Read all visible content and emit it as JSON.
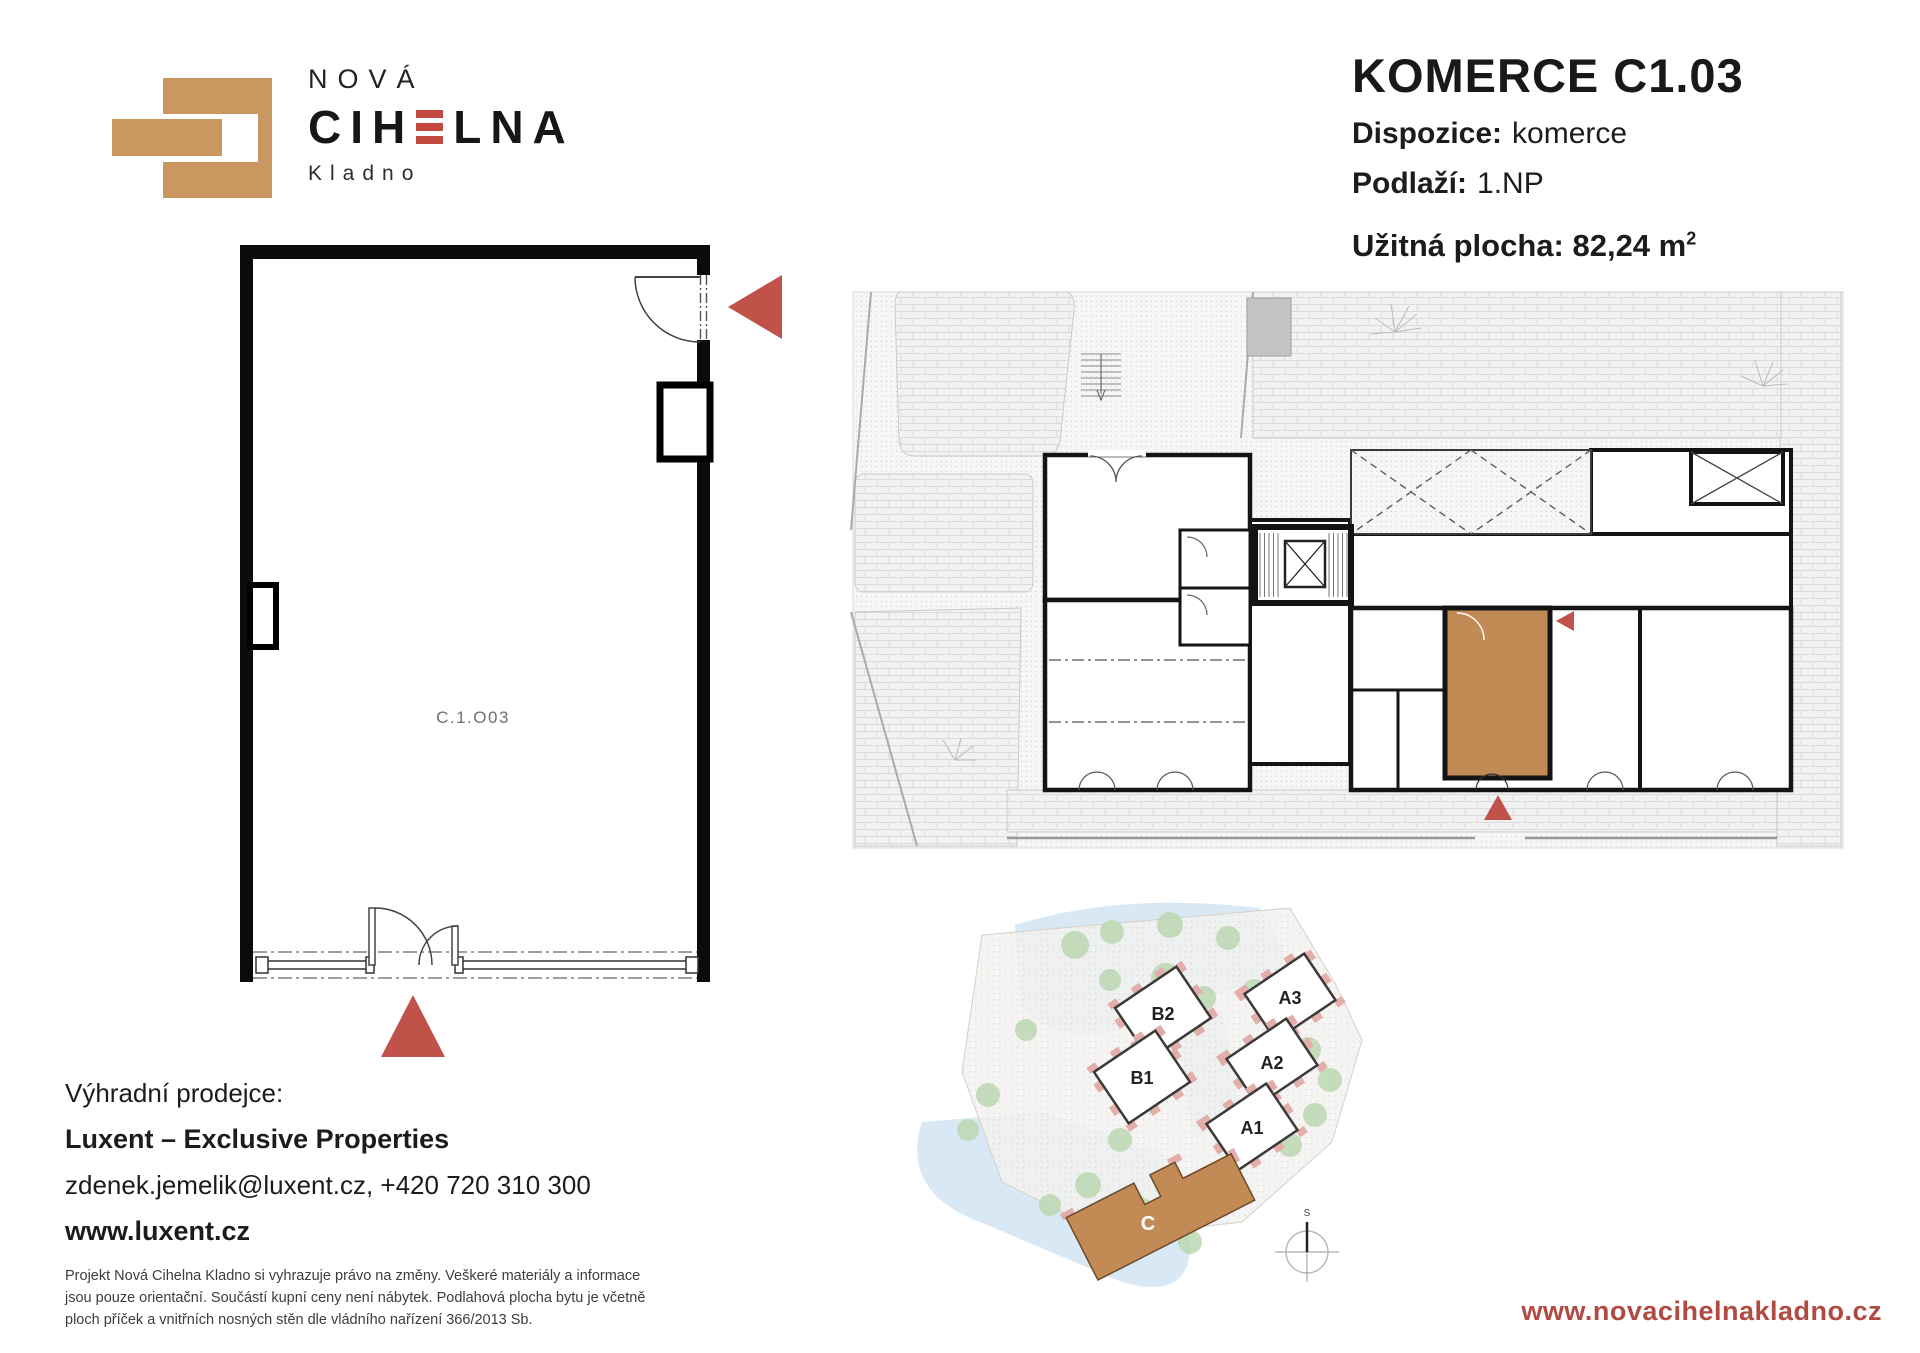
{
  "colors": {
    "brick": "#c9975f",
    "e_bar": "#c2493f",
    "marker_red": "#c0524a",
    "unit_highlight": "#c28b55",
    "url_red": "#b04a42",
    "tree_green": "#b9d6ae",
    "path_blue": "#d9e8f5"
  },
  "logo": {
    "name_top": "NOVÁ",
    "name_main_prefix": "CIH",
    "name_main_suffix": "LNA",
    "city": "Kladno"
  },
  "unit_header": {
    "title": "KOMERCE C1.03",
    "rows": [
      {
        "label": "Dispozice:",
        "value": "komerce"
      },
      {
        "label": "Podlaží:",
        "value": "1.NP"
      }
    ],
    "area_label": "Užitná plocha:",
    "area_value": "82,24 m",
    "area_superscript": "2"
  },
  "floor_plan": {
    "unit_label": "C.1.O03"
  },
  "site_plan": {
    "buildings": [
      "B2",
      "B1",
      "A3",
      "A2",
      "A1"
    ],
    "highlighted_building": "C",
    "compass_label": "S"
  },
  "contact": {
    "heading": "Výhradní prodejce:",
    "company": "Luxent – Exclusive Properties",
    "line": "zdenek.jemelik@luxent.cz, +420 720 310 300",
    "website": "www.luxent.cz"
  },
  "footer": {
    "disclaimer": "Projekt Nová Cihelna Kladno si vyhrazuje právo na změny. Veškeré materiály a informace jsou pouze orientační. Součástí kupní ceny není nábytek. Podlahová plocha bytu je včetně ploch příček a vnitřních nosných stěn dle vládního nařízení 366/2013 Sb.",
    "website": "www.novacihelnakladno.cz"
  }
}
